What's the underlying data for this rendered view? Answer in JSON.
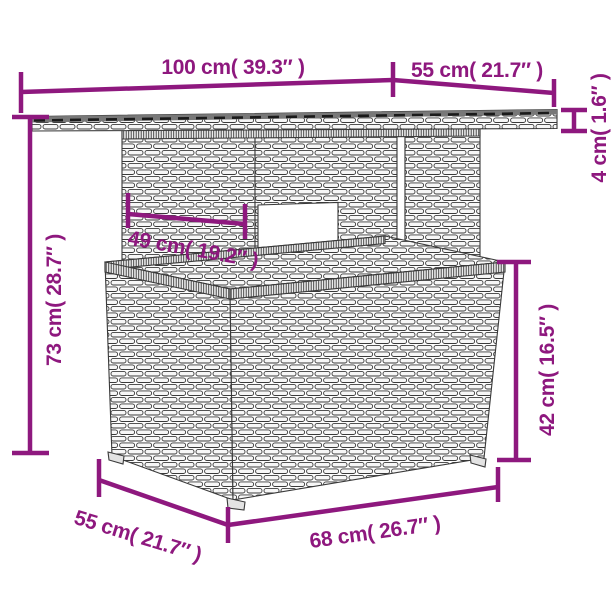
{
  "diagram": {
    "figure": "garden table with glass top and cube stool",
    "accent_color": "#8E187E",
    "sketch_stroke": "#3a3a3a",
    "background": "#ffffff",
    "dims": {
      "tabletop_width": "100 cm( 39.3″ )",
      "tabletop_side": "55 cm( 21.7″ )",
      "tabletop_thickness": "4 cm( 1.6″ )",
      "table_height": "73 cm( 28.7″ )",
      "leg_panel_width": "49 cm( 19.2″ )",
      "stool_height": "42 cm( 16.5″ )",
      "stool_depth": "55 cm( 21.7″ )",
      "stool_width": "68 cm( 26.7″ )"
    }
  }
}
